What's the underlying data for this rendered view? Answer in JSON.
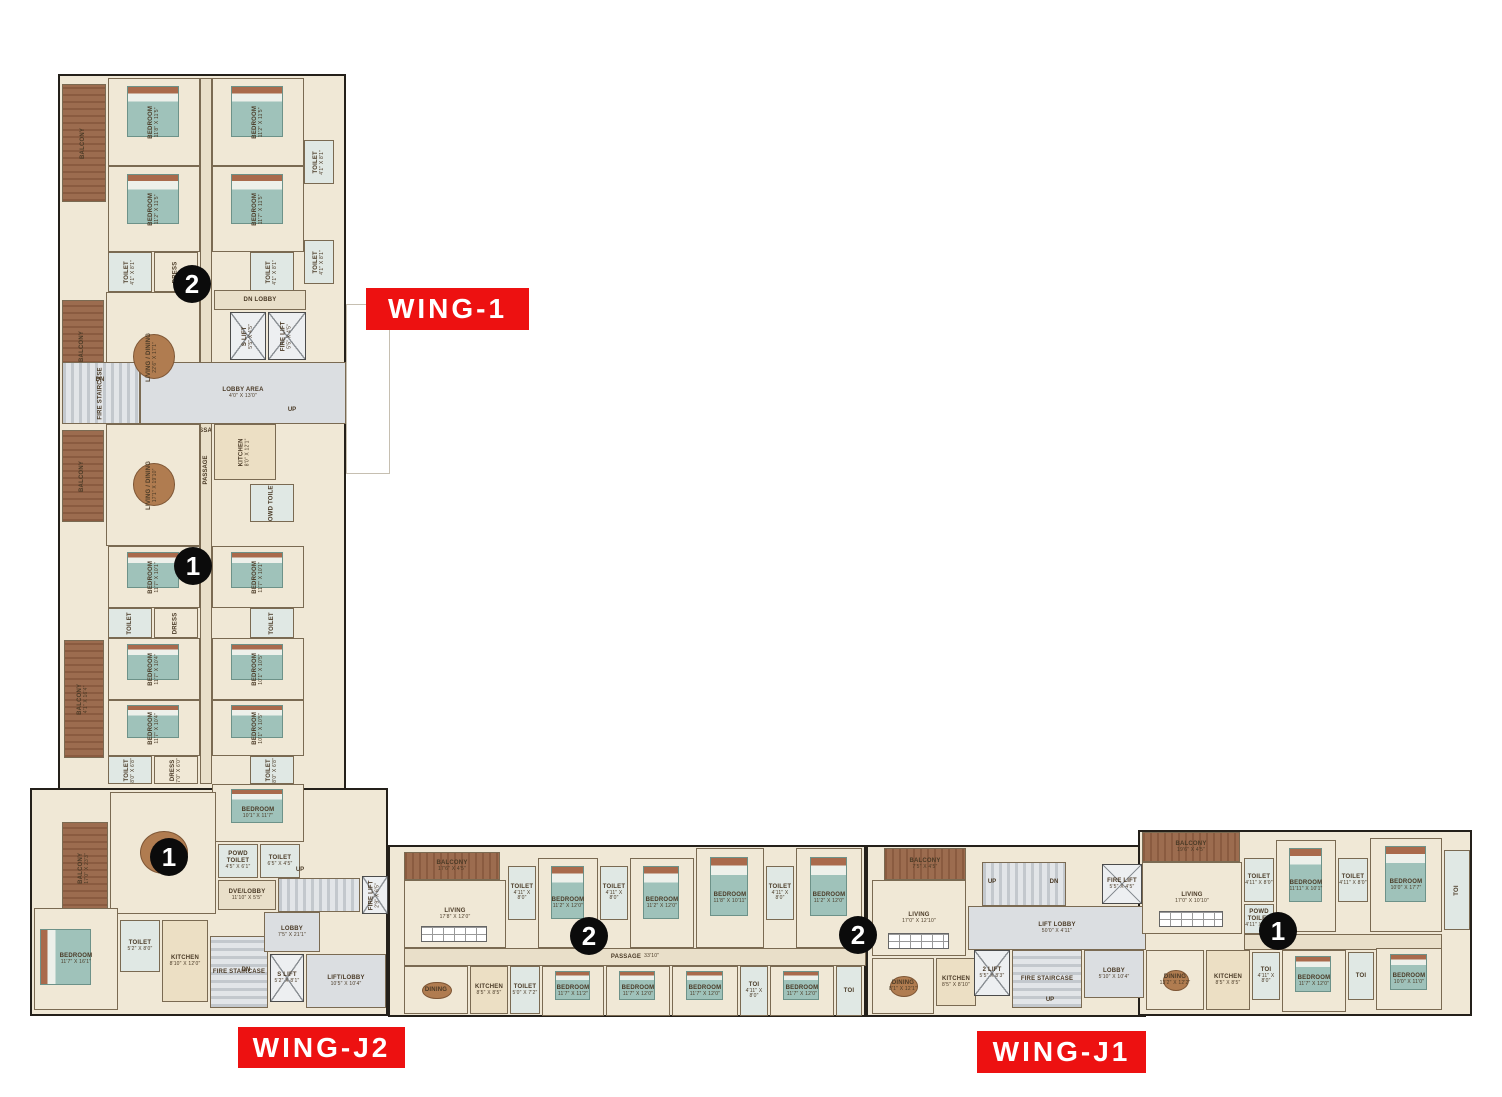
{
  "palette": {
    "red": "#ed1111",
    "floor": "#f0e8d6",
    "floor_dark": "#e9dfc9",
    "balcony": "#9c6c4f",
    "balcony_dark": "#8a5b40",
    "toilet": "#e0e8e4",
    "kitchen": "#ecdfc4",
    "gray": "#dbdee1",
    "lift": "#edeff1",
    "bed": "#9fc2ba",
    "headboard": "#a96a4c",
    "table": "#b07c50",
    "wall": "#24201a",
    "marker": "#0b0b0b"
  },
  "wings": [
    {
      "label": "WING-1",
      "x": 366,
      "y": 288,
      "w": 163,
      "h": 42
    },
    {
      "label": "WING-J2",
      "x": 238,
      "y": 1027,
      "w": 167,
      "h": 41
    },
    {
      "label": "WING-J1",
      "x": 977,
      "y": 1031,
      "w": 169,
      "h": 42
    }
  ],
  "markers": [
    {
      "n": "2",
      "x": 192,
      "y": 284
    },
    {
      "n": "1",
      "x": 193,
      "y": 566
    },
    {
      "n": "1",
      "x": 169,
      "y": 857
    },
    {
      "n": "2",
      "x": 589,
      "y": 936
    },
    {
      "n": "2",
      "x": 858,
      "y": 935
    },
    {
      "n": "1",
      "x": 1278,
      "y": 931
    }
  ],
  "shells": [
    {
      "x": 58,
      "y": 74,
      "w": 288,
      "h": 716
    },
    {
      "x": 30,
      "y": 788,
      "w": 358,
      "h": 228
    },
    {
      "x": 388,
      "y": 845,
      "w": 478,
      "h": 172
    },
    {
      "x": 866,
      "y": 845,
      "w": 280,
      "h": 172
    },
    {
      "x": 1138,
      "y": 830,
      "w": 334,
      "h": 186
    }
  ],
  "ghosts": [
    {
      "x": 346,
      "y": 304,
      "w": 44,
      "h": 170
    }
  ],
  "texts": [
    {
      "t": "UP",
      "x": 992,
      "y": 882
    },
    {
      "t": "DN",
      "x": 1054,
      "y": 882
    },
    {
      "t": "UP",
      "x": 1050,
      "y": 1000
    },
    {
      "t": "DN",
      "x": 100,
      "y": 380
    },
    {
      "t": "UP",
      "x": 292,
      "y": 410
    },
    {
      "t": "PASSAGE",
      "x": 206,
      "y": 470,
      "v": true
    },
    {
      "t": "UP",
      "x": 300,
      "y": 870
    },
    {
      "t": "DN",
      "x": 246,
      "y": 970
    }
  ],
  "rooms": [
    {
      "n": "PASSAGE",
      "x": 200,
      "y": 78,
      "w": 12,
      "h": 706,
      "t": "floor2"
    },
    {
      "n": "BALCONY",
      "x": 62,
      "y": 84,
      "w": 44,
      "h": 118,
      "t": "balcv",
      "v": true
    },
    {
      "n": "BEDROOM",
      "d": "11'8\" X 11'5\"",
      "x": 108,
      "y": 78,
      "w": 92,
      "h": 88,
      "t": "floor",
      "f": "bed",
      "v": true
    },
    {
      "n": "BEDROOM",
      "d": "11'2\" X 11'5\"",
      "x": 212,
      "y": 78,
      "w": 92,
      "h": 88,
      "t": "floor",
      "f": "bed",
      "v": true
    },
    {
      "n": "TOILET",
      "d": "4'1\" X 8'1\"",
      "x": 304,
      "y": 140,
      "w": 30,
      "h": 44,
      "t": "toilet",
      "v": true
    },
    {
      "n": "BEDROOM",
      "d": "11'2\" X 11'5\"",
      "x": 108,
      "y": 166,
      "w": 92,
      "h": 86,
      "t": "floor",
      "f": "bed",
      "v": true
    },
    {
      "n": "BEDROOM",
      "d": "11'7\" X 11'5\"",
      "x": 212,
      "y": 166,
      "w": 92,
      "h": 86,
      "t": "floor",
      "f": "bed",
      "v": true
    },
    {
      "n": "TOILET",
      "d": "4'1\" X 8'1\"",
      "x": 304,
      "y": 240,
      "w": 30,
      "h": 44,
      "t": "toilet",
      "v": true
    },
    {
      "n": "TOILET",
      "d": "4'1\" X 8'1\"",
      "x": 108,
      "y": 252,
      "w": 44,
      "h": 40,
      "t": "toilet",
      "v": true
    },
    {
      "n": "DRESS",
      "x": 154,
      "y": 252,
      "w": 44,
      "h": 40,
      "t": "floor",
      "v": true
    },
    {
      "n": "TOILET",
      "d": "4'1\" X 8'1\"",
      "x": 250,
      "y": 252,
      "w": 44,
      "h": 40,
      "t": "toilet",
      "v": true
    },
    {
      "n": "BALCONY",
      "x": 62,
      "y": 300,
      "w": 42,
      "h": 92,
      "t": "balcv",
      "v": true
    },
    {
      "n": "LIVING / DINING",
      "d": "22'6\" X 17'1\"",
      "x": 106,
      "y": 292,
      "w": 94,
      "h": 130,
      "t": "floor",
      "f": "table",
      "v": true
    },
    {
      "n": "DN LOBBY",
      "x": 214,
      "y": 290,
      "w": 92,
      "h": 20,
      "t": "floor2"
    },
    {
      "n": "S LIFT",
      "d": "5'5\" X 4'5\"",
      "x": 230,
      "y": 312,
      "w": 36,
      "h": 48,
      "t": "lift",
      "v": true
    },
    {
      "n": "FIRE LIFT",
      "d": "5'5\" X 4'5\"",
      "x": 268,
      "y": 312,
      "w": 38,
      "h": 48,
      "t": "lift",
      "v": true
    },
    {
      "n": "FIRE STAIRCASE",
      "x": 62,
      "y": 362,
      "w": 78,
      "h": 62,
      "t": "stairsh",
      "v": true
    },
    {
      "n": "LOBBY AREA",
      "d": "4'0\" X 13'0\"",
      "x": 140,
      "y": 362,
      "w": 206,
      "h": 62,
      "t": "gray"
    },
    {
      "n": "BALCONY",
      "x": 62,
      "y": 430,
      "w": 42,
      "h": 92,
      "t": "balcv",
      "v": true
    },
    {
      "n": "LIVING / DINING",
      "d": "17'1\" X 19'10\"",
      "x": 106,
      "y": 424,
      "w": 94,
      "h": 122,
      "t": "floor",
      "f": "table",
      "v": true
    },
    {
      "n": "KITCHEN",
      "d": "8'0\" X 12'1\"",
      "x": 214,
      "y": 424,
      "w": 62,
      "h": 56,
      "t": "kitchen",
      "v": true
    },
    {
      "n": "POWD TOILET",
      "x": 250,
      "y": 484,
      "w": 44,
      "h": 38,
      "t": "toilet",
      "v": true
    },
    {
      "n": "BEDROOM",
      "d": "11'7\" X 10'1\"",
      "x": 108,
      "y": 546,
      "w": 92,
      "h": 62,
      "t": "floor",
      "f": "bed",
      "v": true
    },
    {
      "n": "BEDROOM",
      "d": "11'7\" X 10'1\"",
      "x": 212,
      "y": 546,
      "w": 92,
      "h": 62,
      "t": "floor",
      "f": "bed",
      "v": true
    },
    {
      "n": "TOILET",
      "x": 108,
      "y": 608,
      "w": 44,
      "h": 30,
      "t": "toilet",
      "v": true
    },
    {
      "n": "DRESS",
      "x": 154,
      "y": 608,
      "w": 44,
      "h": 30,
      "t": "floor",
      "v": true
    },
    {
      "n": "TOILET",
      "x": 250,
      "y": 608,
      "w": 44,
      "h": 30,
      "t": "toilet",
      "v": true
    },
    {
      "n": "BALCONY",
      "d": "4'1\" X 16'4\"",
      "x": 64,
      "y": 640,
      "w": 40,
      "h": 118,
      "t": "balcv",
      "v": true
    },
    {
      "n": "BEDROOM",
      "d": "11'7\" X 10'4\"",
      "x": 108,
      "y": 638,
      "w": 92,
      "h": 62,
      "t": "floor",
      "f": "bed",
      "v": true
    },
    {
      "n": "BEDROOM",
      "d": "10'1\" X 10'5\"",
      "x": 212,
      "y": 638,
      "w": 92,
      "h": 62,
      "t": "floor",
      "f": "bed",
      "v": true
    },
    {
      "n": "BEDROOM",
      "d": "11'7\" X 10'4\"",
      "x": 108,
      "y": 700,
      "w": 92,
      "h": 56,
      "t": "floor",
      "f": "bed",
      "v": true
    },
    {
      "n": "BEDROOM",
      "d": "10'1\" X 10'5\"",
      "x": 212,
      "y": 700,
      "w": 92,
      "h": 56,
      "t": "floor",
      "f": "bed",
      "v": true
    },
    {
      "n": "TOILET",
      "d": "8'0\" X 6'8\"",
      "x": 108,
      "y": 756,
      "w": 44,
      "h": 28,
      "t": "toilet",
      "v": true
    },
    {
      "n": "DRESS",
      "d": "7'0\" X 6'0\"",
      "x": 154,
      "y": 756,
      "w": 44,
      "h": 28,
      "t": "floor",
      "v": true
    },
    {
      "n": "TOILET",
      "d": "8'0\" X 6'8\"",
      "x": 250,
      "y": 756,
      "w": 44,
      "h": 28,
      "t": "toilet",
      "v": true
    },
    {
      "n": "BEDROOM",
      "d": "10'1\" X 11'7\"",
      "x": 212,
      "y": 784,
      "w": 92,
      "h": 58,
      "t": "floor",
      "f": "bed"
    },
    {
      "n": "BALCONY",
      "d": "17'0\" X 23'3\"",
      "x": 62,
      "y": 822,
      "w": 46,
      "h": 92,
      "t": "balcv",
      "v": true
    },
    {
      "n": "LIVING",
      "d": "17'5\"",
      "x": 110,
      "y": 792,
      "w": 106,
      "h": 122,
      "t": "floor",
      "f": "table"
    },
    {
      "n": "POWD TOILET",
      "d": "4'5\" X 6'1\"",
      "x": 218,
      "y": 844,
      "w": 40,
      "h": 34,
      "t": "toilet"
    },
    {
      "n": "TOILET",
      "d": "6'5\" X 4'5\"",
      "x": 260,
      "y": 844,
      "w": 40,
      "h": 34,
      "t": "toilet"
    },
    {
      "n": "DVE/LOBBY",
      "d": "11'10\" X 5'5\"",
      "x": 218,
      "y": 880,
      "w": 58,
      "h": 30,
      "t": "floor2"
    },
    {
      "x": 278,
      "y": 878,
      "w": 82,
      "h": 34,
      "t": "stairsh"
    },
    {
      "n": "FIRE LIFT",
      "d": "2'9\" X 6'5\"",
      "x": 362,
      "y": 876,
      "w": 26,
      "h": 38,
      "t": "lift",
      "v": true
    },
    {
      "n": "BEDROOM",
      "d": "11'7\" X 16'1\"",
      "x": 34,
      "y": 908,
      "w": 84,
      "h": 102,
      "t": "floor",
      "f": "bedh"
    },
    {
      "n": "TOILET",
      "d": "5'2\" X 8'0\"",
      "x": 120,
      "y": 920,
      "w": 40,
      "h": 52,
      "t": "toilet"
    },
    {
      "n": "KITCHEN",
      "d": "8'10\" X 12'0\"",
      "x": 162,
      "y": 920,
      "w": 46,
      "h": 82,
      "t": "kitchen"
    },
    {
      "n": "FIRE STAIRCASE",
      "x": 210,
      "y": 936,
      "w": 58,
      "h": 72,
      "t": "stairsv"
    },
    {
      "n": "LOBBY",
      "d": "7'5\" X 21'1\"",
      "x": 264,
      "y": 912,
      "w": 56,
      "h": 40,
      "t": "gray"
    },
    {
      "n": "S LIFT",
      "d": "5'2\" X 8'1\"",
      "x": 270,
      "y": 954,
      "w": 34,
      "h": 48,
      "t": "lift"
    },
    {
      "n": "LIFT/LOBBY",
      "d": "10'5\" X 10'4\"",
      "x": 306,
      "y": 954,
      "w": 80,
      "h": 54,
      "t": "gray"
    },
    {
      "n": "BALCONY",
      "d": "17'6\" X 4'5\"",
      "x": 404,
      "y": 852,
      "w": 96,
      "h": 28,
      "t": "balch"
    },
    {
      "n": "LIVING",
      "d": "17'8\" X 12'0\"",
      "x": 404,
      "y": 880,
      "w": 102,
      "h": 68,
      "t": "floor",
      "f": "utable"
    },
    {
      "n": "TOILET",
      "d": "4'11\" X 8'0\"",
      "x": 508,
      "y": 866,
      "w": 28,
      "h": 54,
      "t": "toilet"
    },
    {
      "n": "BEDROOM",
      "d": "11'2\" X 12'0\"",
      "x": 538,
      "y": 858,
      "w": 60,
      "h": 90,
      "t": "floor",
      "f": "bed"
    },
    {
      "n": "TOILET",
      "d": "4'11\" X 8'0\"",
      "x": 600,
      "y": 866,
      "w": 28,
      "h": 54,
      "t": "toilet"
    },
    {
      "n": "BEDROOM",
      "d": "11'2\" X 12'0\"",
      "x": 630,
      "y": 858,
      "w": 64,
      "h": 90,
      "t": "floor",
      "f": "bed"
    },
    {
      "n": "BEDROOM",
      "d": "11'8\" X 10'11\"",
      "x": 696,
      "y": 848,
      "w": 68,
      "h": 100,
      "t": "floor",
      "f": "bed"
    },
    {
      "n": "TOILET",
      "d": "4'11\" X 8'0\"",
      "x": 766,
      "y": 866,
      "w": 28,
      "h": 54,
      "t": "toilet"
    },
    {
      "n": "BEDROOM",
      "d": "11'2\" X 12'0\"",
      "x": 796,
      "y": 848,
      "w": 66,
      "h": 100,
      "t": "floor",
      "f": "bed"
    },
    {
      "n": "PASSAGE",
      "d": "33'10\"",
      "x": 404,
      "y": 948,
      "w": 462,
      "h": 18,
      "t": "floor2"
    },
    {
      "n": "DINING",
      "x": 404,
      "y": 966,
      "w": 64,
      "h": 48,
      "t": "floor",
      "f": "table"
    },
    {
      "n": "KITCHEN",
      "d": "8'5\" X 8'5\"",
      "x": 470,
      "y": 966,
      "w": 38,
      "h": 48,
      "t": "kitchen"
    },
    {
      "n": "TOILET",
      "d": "5'0\" X 7'2\"",
      "x": 510,
      "y": 966,
      "w": 30,
      "h": 48,
      "t": "toilet"
    },
    {
      "n": "BEDROOM",
      "d": "11'7\" X 11'2\"",
      "x": 542,
      "y": 966,
      "w": 62,
      "h": 50,
      "t": "floor",
      "f": "bed"
    },
    {
      "n": "BEDROOM",
      "d": "11'7\" X 12'0\"",
      "x": 606,
      "y": 966,
      "w": 64,
      "h": 50,
      "t": "floor",
      "f": "bed"
    },
    {
      "n": "BEDROOM",
      "d": "11'7\" X 12'0\"",
      "x": 672,
      "y": 966,
      "w": 66,
      "h": 50,
      "t": "floor",
      "f": "bed"
    },
    {
      "n": "TOI",
      "d": "4'11\" X 8'0\"",
      "x": 740,
      "y": 966,
      "w": 28,
      "h": 50,
      "t": "toilet"
    },
    {
      "n": "BEDROOM",
      "d": "11'7\" X 12'0\"",
      "x": 770,
      "y": 966,
      "w": 64,
      "h": 50,
      "t": "floor",
      "f": "bed"
    },
    {
      "n": "TOI",
      "x": 836,
      "y": 966,
      "w": 26,
      "h": 50,
      "t": "toilet"
    },
    {
      "n": "BALCONY",
      "d": "7'5\" X 4'5\"",
      "x": 884,
      "y": 848,
      "w": 82,
      "h": 32,
      "t": "balch"
    },
    {
      "n": "LIVING",
      "d": "17'0\" X 12'10\"",
      "x": 872,
      "y": 880,
      "w": 94,
      "h": 76,
      "t": "floor",
      "f": "utable"
    },
    {
      "n": "DINING",
      "d": "8'1\" X 12'1\"",
      "x": 872,
      "y": 958,
      "w": 62,
      "h": 56,
      "t": "floor",
      "f": "table"
    },
    {
      "n": "KITCHEN",
      "d": "8'5\" X 8'10\"",
      "x": 936,
      "y": 958,
      "w": 40,
      "h": 48,
      "t": "kitchen"
    },
    {
      "x": 982,
      "y": 862,
      "w": 84,
      "h": 44,
      "t": "stairsh"
    },
    {
      "n": "LIFT LOBBY",
      "d": "50'0\" X 4'11\"",
      "x": 968,
      "y": 906,
      "w": 178,
      "h": 44,
      "t": "gray"
    },
    {
      "n": "FIRE LIFT",
      "d": "5'5\" X 4'5\"",
      "x": 1102,
      "y": 864,
      "w": 40,
      "h": 40,
      "t": "lift"
    },
    {
      "n": "2 LIFT",
      "d": "5'5\" X 8'3\"",
      "x": 974,
      "y": 950,
      "w": 36,
      "h": 46,
      "t": "lift"
    },
    {
      "n": "FIRE STAIRCASE",
      "x": 1012,
      "y": 950,
      "w": 70,
      "h": 58,
      "t": "stairsv"
    },
    {
      "n": "LOBBY",
      "d": "5'10\" X 10'4\"",
      "x": 1084,
      "y": 950,
      "w": 60,
      "h": 48,
      "t": "gray"
    },
    {
      "n": "BALCONY",
      "d": "19'6\" X 4'5\"",
      "x": 1142,
      "y": 832,
      "w": 98,
      "h": 30,
      "t": "balch"
    },
    {
      "n": "LIVING",
      "d": "17'0\" X 10'10\"",
      "x": 1142,
      "y": 862,
      "w": 100,
      "h": 72,
      "t": "floor",
      "f": "utable"
    },
    {
      "n": "TOILET",
      "d": "4'11\" X 8'0\"",
      "x": 1244,
      "y": 858,
      "w": 30,
      "h": 44,
      "t": "toilet"
    },
    {
      "n": "POWD TOILET",
      "d": "4'11\" X 4'1\"",
      "x": 1244,
      "y": 904,
      "w": 30,
      "h": 30,
      "t": "toilet"
    },
    {
      "n": "BEDROOM",
      "d": "11'11\" X 10'1\"",
      "x": 1276,
      "y": 840,
      "w": 60,
      "h": 92,
      "t": "floor",
      "f": "bed"
    },
    {
      "n": "TOILET",
      "d": "4'11\" X 8'0\"",
      "x": 1338,
      "y": 858,
      "w": 30,
      "h": 44,
      "t": "toilet"
    },
    {
      "n": "BEDROOM",
      "d": "10'0\" X 17'7\"",
      "x": 1370,
      "y": 838,
      "w": 72,
      "h": 94,
      "t": "floor",
      "f": "bed"
    },
    {
      "n": "TOI",
      "x": 1444,
      "y": 850,
      "w": 26,
      "h": 80,
      "t": "toilet",
      "v": true
    },
    {
      "x": 1244,
      "y": 934,
      "w": 198,
      "h": 16,
      "t": "floor2"
    },
    {
      "n": "DINING",
      "d": "13'2\" X 12'2\"",
      "x": 1146,
      "y": 950,
      "w": 58,
      "h": 60,
      "t": "floor",
      "f": "table"
    },
    {
      "n": "KITCHEN",
      "d": "8'5\" X 8'5\"",
      "x": 1206,
      "y": 950,
      "w": 44,
      "h": 60,
      "t": "kitchen"
    },
    {
      "n": "TOI",
      "d": "4'11\" X 8'0\"",
      "x": 1252,
      "y": 952,
      "w": 28,
      "h": 48,
      "t": "toilet"
    },
    {
      "n": "BEDROOM",
      "d": "11'7\" X 12'0\"",
      "x": 1282,
      "y": 950,
      "w": 64,
      "h": 62,
      "t": "floor",
      "f": "bed"
    },
    {
      "n": "TOI",
      "x": 1348,
      "y": 952,
      "w": 26,
      "h": 48,
      "t": "toilet"
    },
    {
      "n": "BEDROOM",
      "d": "10'0\" X 11'0\"",
      "x": 1376,
      "y": 948,
      "w": 66,
      "h": 62,
      "t": "floor",
      "f": "bed"
    }
  ]
}
